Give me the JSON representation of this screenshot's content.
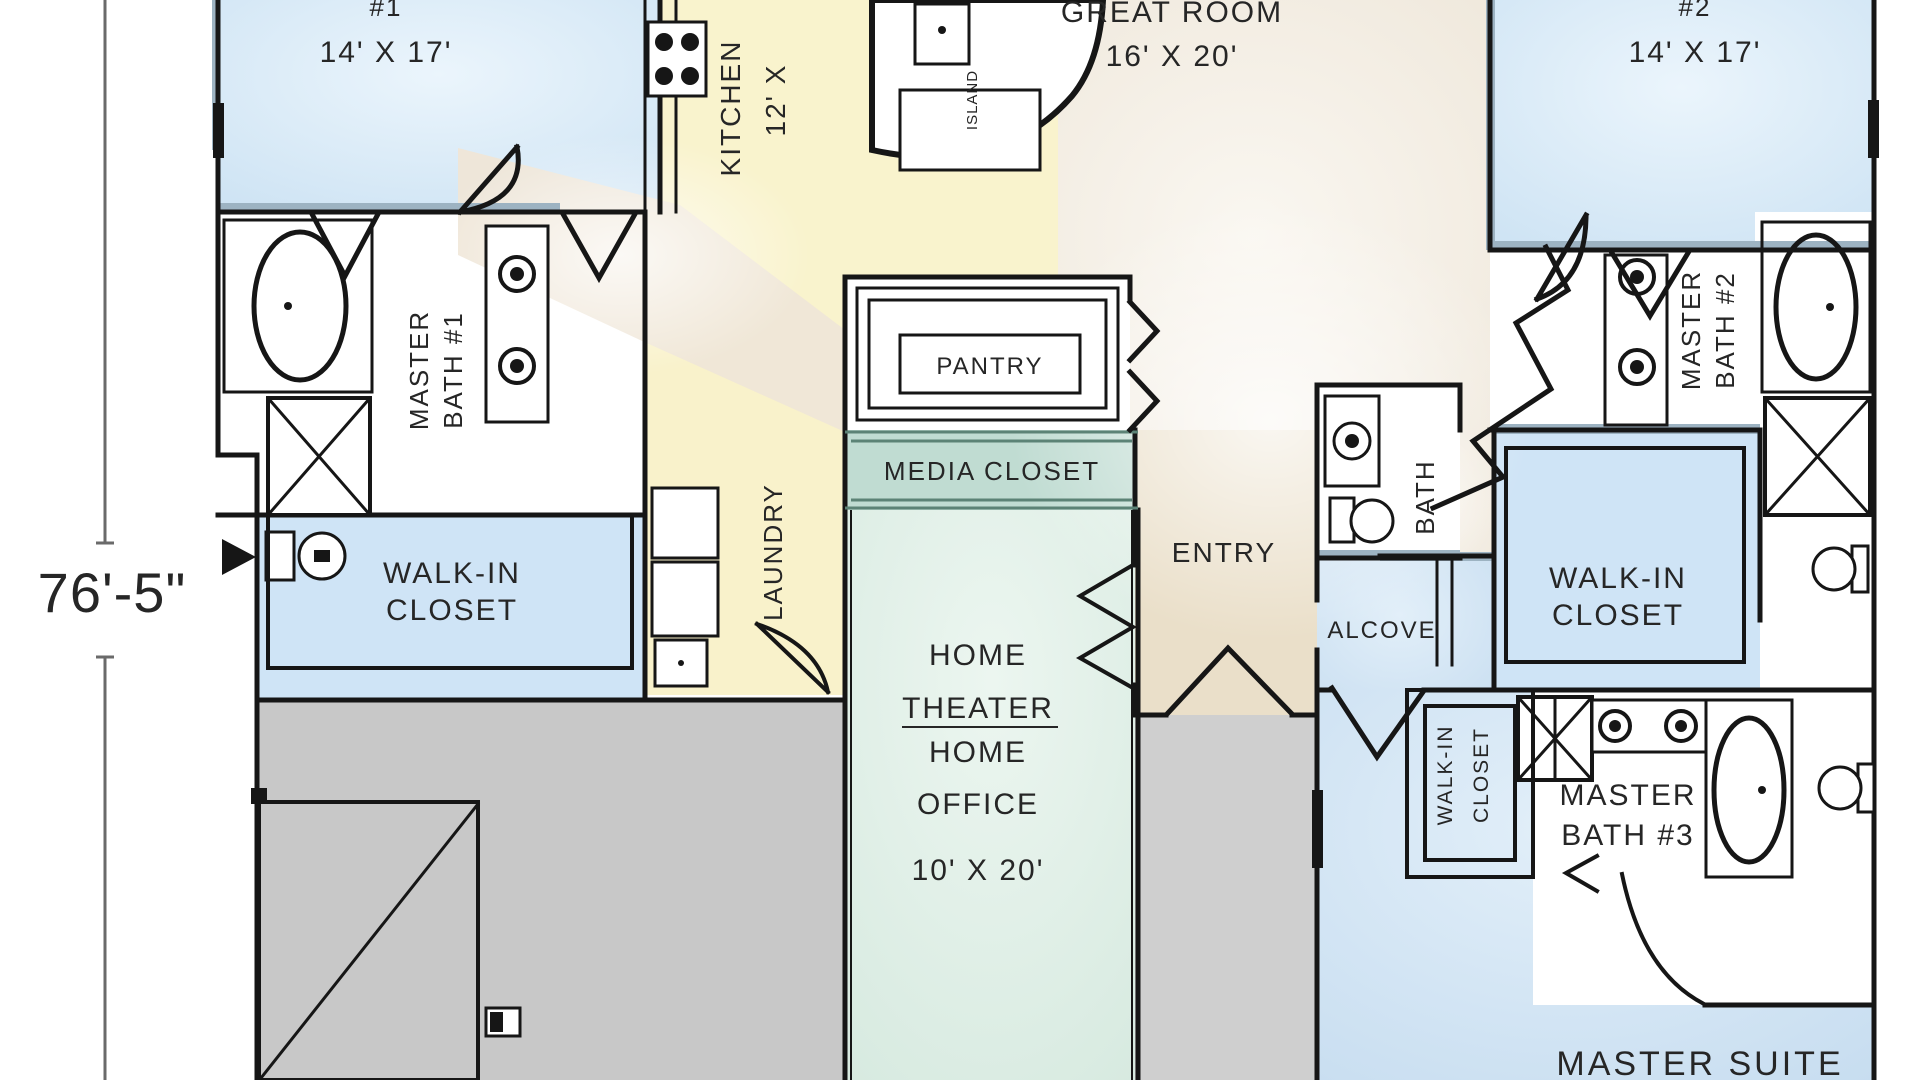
{
  "dimension": {
    "label": "76'-5\""
  },
  "rooms": {
    "bedroom1": {
      "number": "#1",
      "size": "14' X 17'"
    },
    "bedroom2": {
      "number": "#2",
      "size": "14' X 17'"
    },
    "kitchen": {
      "name": "KITCHEN",
      "size": "12' X"
    },
    "island": {
      "name": "ISLAND"
    },
    "great_room": {
      "name": "GREAT ROOM",
      "size": "16' X 20'"
    },
    "master_bath1": {
      "line1": "MASTER",
      "line2": "BATH #1"
    },
    "master_bath2": {
      "line1": "MASTER",
      "line2": "BATH #2"
    },
    "master_bath3": {
      "line1": "MASTER",
      "line2": "BATH #3"
    },
    "pantry": {
      "name": "PANTRY"
    },
    "media_closet": {
      "name": "MEDIA CLOSET"
    },
    "entry": {
      "name": "ENTRY"
    },
    "bath": {
      "name": "BATH"
    },
    "alcove": {
      "name": "ALCOVE"
    },
    "laundry": {
      "name": "LAUNDRY"
    },
    "walkin_left": {
      "line1": "WALK-IN",
      "line2": "CLOSET"
    },
    "walkin_right": {
      "line1": "WALK-IN",
      "line2": "CLOSET"
    },
    "walkin_small": {
      "line1": "WALK-IN",
      "line2": "CLOSET"
    },
    "home_theater": {
      "line1": "HOME",
      "line2": "THEATER",
      "line3": "HOME",
      "line4": "OFFICE",
      "size": "10' X 20'"
    },
    "master_suite": {
      "name": "MASTER SUITE"
    }
  },
  "colors": {
    "bedroom": "#cfe4f4",
    "bedroom_hi": "#ebf5fc",
    "great": "#f0e9dd",
    "great_hi": "#faf7f1",
    "entry_beige": "#eadfc9",
    "kitchen_yellow": "#f9f3cd",
    "corridor_beige": "#efe6d7",
    "laundry_yellow": "#f9f2cb",
    "teal": "#d7eae0",
    "teal_hi": "#ecf6f0",
    "media_band": "#c0dcd2",
    "closet_blue": "#cfe4f6",
    "suite_blue": "#c7ddf0",
    "suite_hi": "#e2eff9",
    "garage_gray": "#c8c8c8",
    "porch_gray": "#cfcfcf",
    "wall": "#161616",
    "sill": "#9db3c2",
    "teal_line": "#5c8376",
    "text": "#262626"
  }
}
